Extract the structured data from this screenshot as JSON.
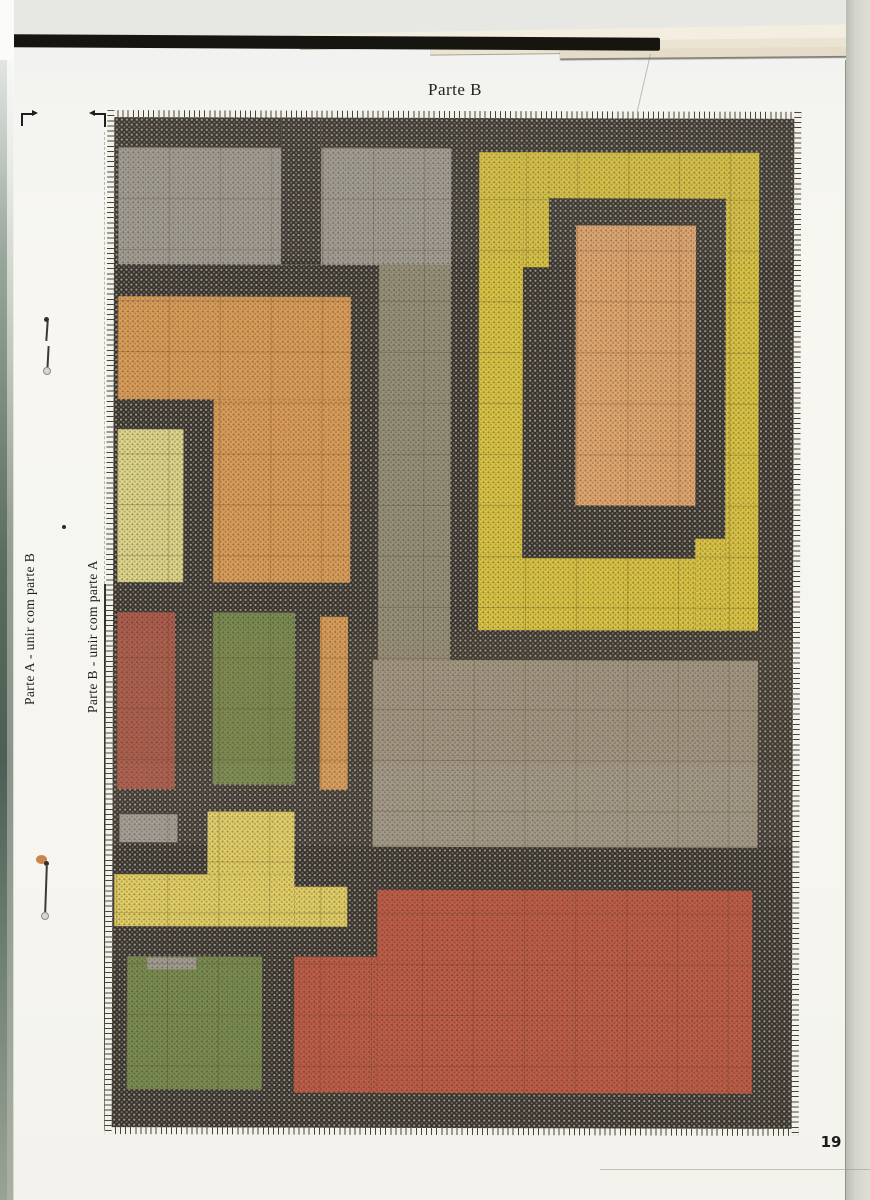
{
  "page": {
    "title": "Parte B",
    "page_number": "19",
    "side_label_a": "Parte A - unir com parte B",
    "side_label_b": "Parte B - unir com parte A"
  },
  "pattern": {
    "description": "cross-stitch color chart",
    "palette": {
      "dark": "#37322b",
      "gray1": "#a7a39a",
      "gray2": "#9a957e",
      "gray3": "#a69d8b",
      "orange": "#e1a35e",
      "orangelight": "#e7ac74",
      "yellow": "#dfca48",
      "yellowT": "#e9d66b",
      "yellowpale": "#e4dd90",
      "green": "#7d9055",
      "red": "#c3604b",
      "redsmall": "#b25f50"
    },
    "blocks": [
      {
        "name": "gray-top-left",
        "color": "gray1",
        "shade": "light",
        "rect": [
          4,
          30,
          333,
          117
        ]
      },
      {
        "name": "dark-bar-top",
        "color": "dark",
        "shade": "dark",
        "rect": [
          167,
          0,
          40,
          147
        ]
      },
      {
        "name": "gray-column",
        "color": "gray2",
        "shade": "light",
        "rect": [
          265,
          147,
          72,
          395
        ]
      },
      {
        "name": "gray-middle",
        "color": "gray3",
        "shade": "light",
        "rect": [
          260,
          542,
          385,
          187
        ]
      },
      {
        "name": "orange-block-top",
        "color": "orange",
        "shade": "light",
        "rect": [
          4,
          179,
          233,
          103
        ]
      },
      {
        "name": "orange-block-bottom",
        "color": "orange",
        "shade": "light",
        "rect": [
          100,
          282,
          137,
          183
        ]
      },
      {
        "name": "pale-yellow-block",
        "color": "yellowpale",
        "shade": "light",
        "rect": [
          4,
          312,
          66,
          153
        ]
      },
      {
        "name": "red-small-block",
        "color": "redsmall",
        "shade": "light",
        "rect": [
          4,
          495,
          58,
          177
        ]
      },
      {
        "name": "green-small-block",
        "color": "green",
        "shade": "light",
        "rect": [
          100,
          495,
          82,
          172
        ]
      },
      {
        "name": "orange-bar",
        "color": "orange",
        "shade": "light",
        "rect": [
          207,
          499,
          28,
          173
        ]
      },
      {
        "name": "gray-small-bar",
        "color": "gray1",
        "shade": "light",
        "rect": [
          7,
          697,
          58,
          28
        ]
      },
      {
        "name": "yellow-t-vertical",
        "color": "yellowT",
        "shade": "light",
        "rect": [
          95,
          694,
          87,
          63
        ]
      },
      {
        "name": "yellow-t-horizontal",
        "color": "yellowT",
        "shade": "light",
        "rect": [
          2,
          757,
          180,
          52
        ]
      },
      {
        "name": "yellow-t-extension",
        "color": "yellowT",
        "shade": "light",
        "rect": [
          182,
          769,
          53,
          40
        ]
      },
      {
        "name": "green-big-block",
        "color": "green",
        "shade": "light",
        "rect": [
          15,
          839,
          135,
          133
        ]
      },
      {
        "name": "gray-notch",
        "color": "gray1",
        "shade": "light",
        "rect": [
          35,
          840,
          49,
          12
        ]
      },
      {
        "name": "red-big-block",
        "color": "red",
        "shade": "light",
        "rect": [
          265,
          772,
          375,
          203
        ]
      },
      {
        "name": "red-big-extension",
        "color": "red",
        "shade": "light",
        "rect": [
          182,
          839,
          83,
          136
        ]
      },
      {
        "name": "yellow-ring-outer",
        "color": "yellow",
        "shade": "light",
        "rect": [
          365,
          34,
          280,
          478
        ]
      },
      {
        "name": "dark-ring",
        "color": "dark",
        "shade": "dark",
        "rect": [
          409,
          80,
          203,
          360
        ]
      },
      {
        "name": "yellow-patch-top-left",
        "color": "yellow",
        "shade": "light",
        "rect": [
          409,
          34,
          26,
          115
        ]
      },
      {
        "name": "yellow-patch-bottom-right",
        "color": "yellow",
        "shade": "light",
        "rect": [
          582,
          420,
          30,
          92
        ]
      },
      {
        "name": "orange-inner-block",
        "color": "orangelight",
        "shade": "light",
        "rect": [
          462,
          107,
          120,
          280
        ]
      }
    ]
  }
}
